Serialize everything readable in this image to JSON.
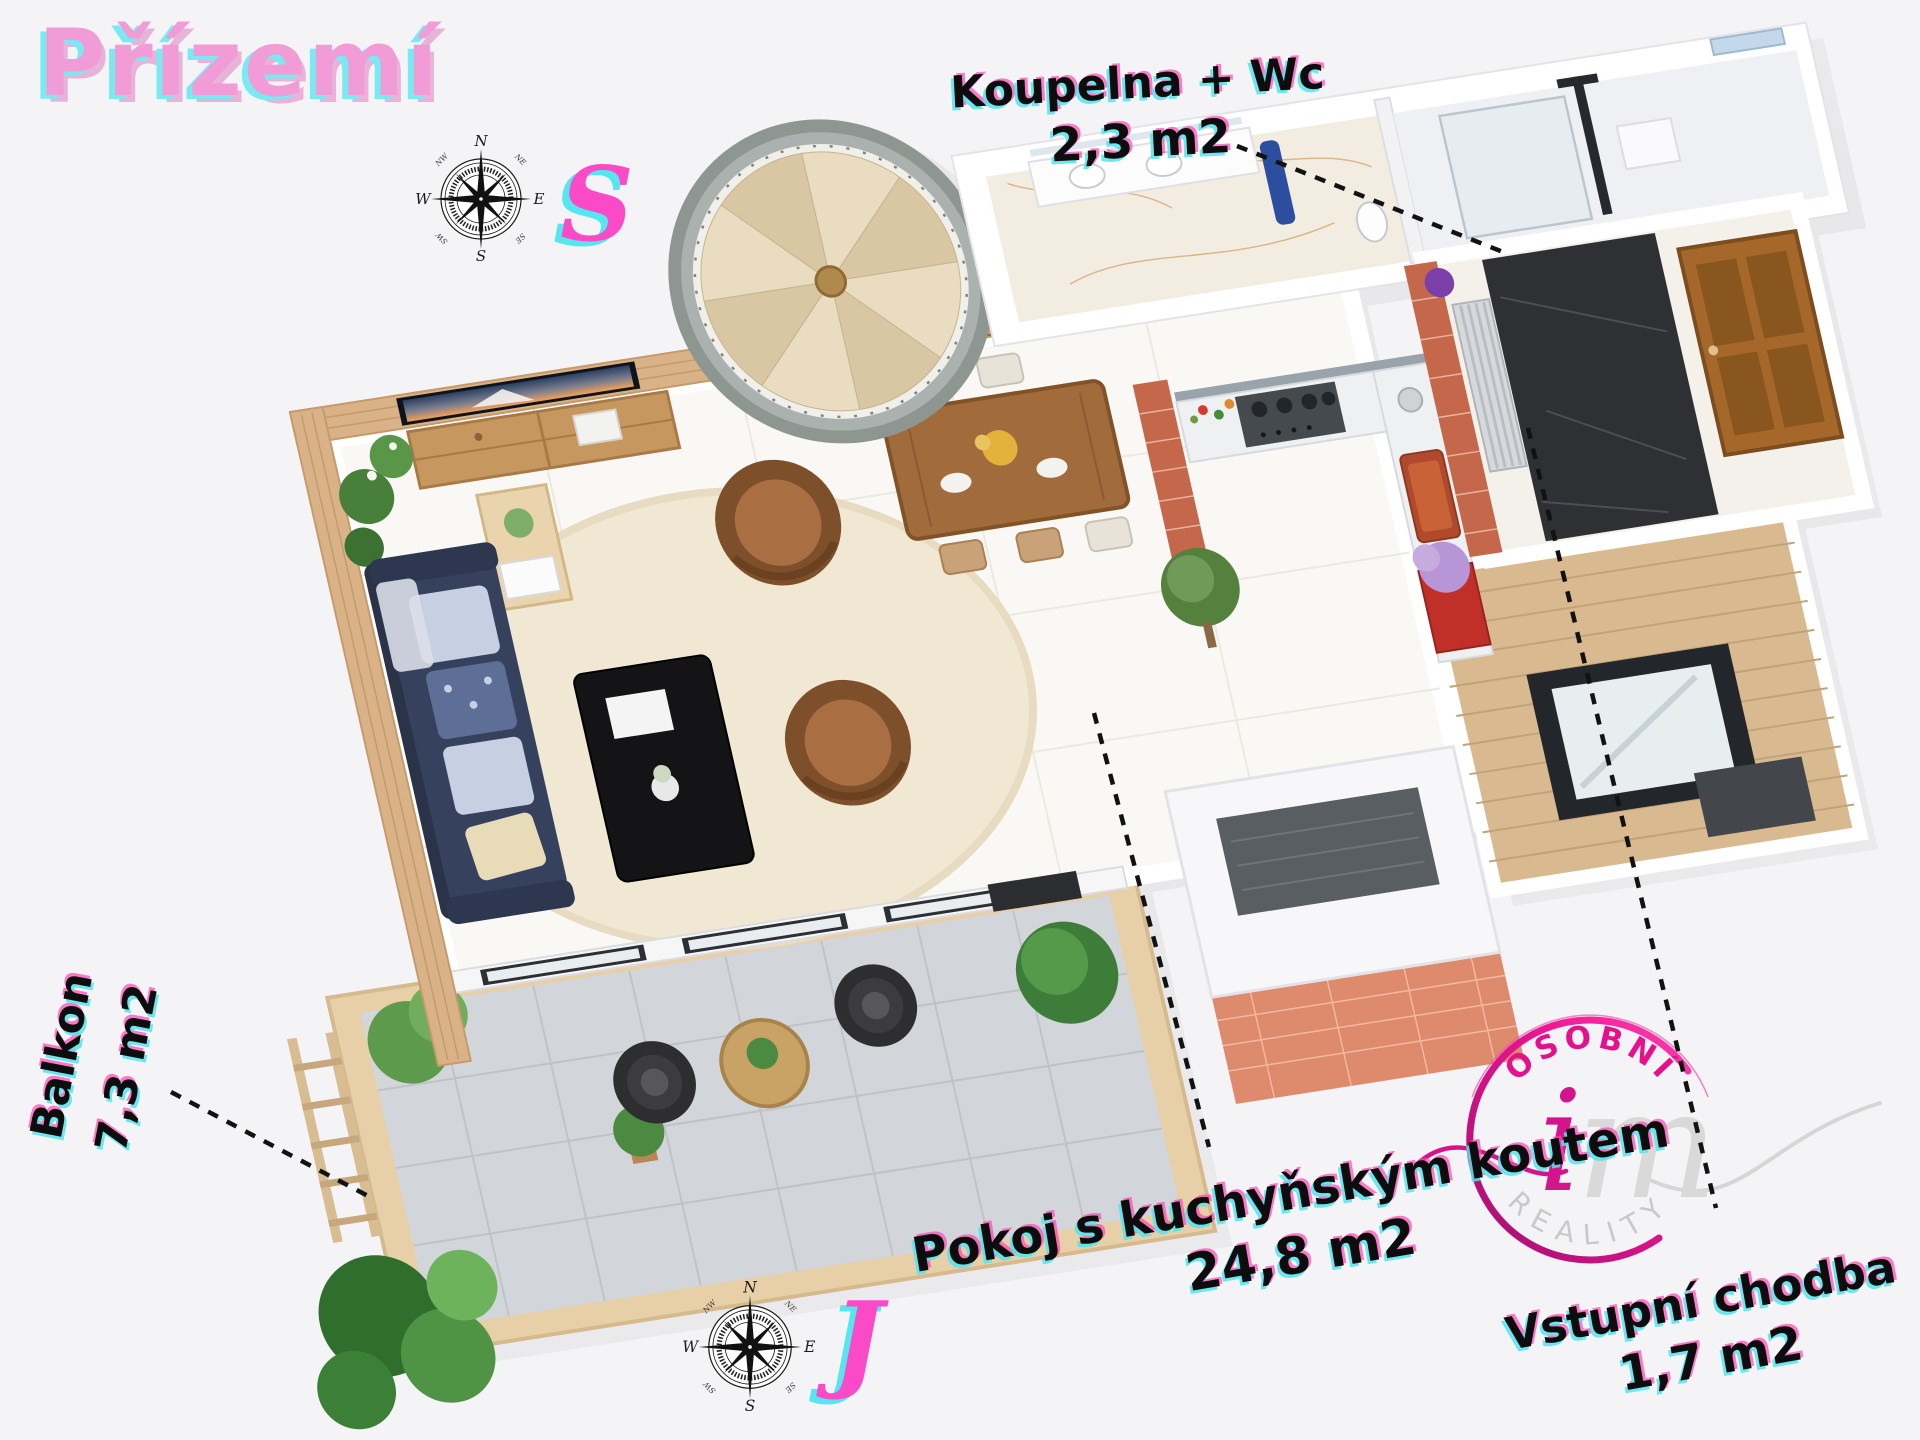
{
  "title": {
    "text": "Přízemí"
  },
  "direction_markers": {
    "top": "S",
    "bottom": "J"
  },
  "compass": {
    "n": "N",
    "e": "E",
    "s": "S",
    "w": "W",
    "nw": "NW",
    "ne": "NE",
    "sw": "SW",
    "se": "SE"
  },
  "room_labels": {
    "bathroom": {
      "name": "Koupelna + Wc",
      "area": "2,3 m2"
    },
    "balcony": {
      "name": "Balkon",
      "area": "7,3 m2"
    },
    "living_kitchen": {
      "name": "Pokoj s kuchyňským koutem",
      "area": "24,8 m2"
    },
    "entrance_hall": {
      "name": "Vstupní chodba",
      "area": "1,7 m2"
    }
  },
  "logo": {
    "arc_top": "OSOBNÍ",
    "monogram_i": "i",
    "monogram_m": "m",
    "arc_bottom": "REALITY"
  },
  "colors": {
    "background": "#f4f4f6",
    "title_pink": "#f19cd6",
    "marker_pink": "#fb4ac7",
    "shadow_cyan": "#6ce7f0",
    "fringe_magenta": "#ff44b3",
    "label_ink": "#0e0d0e",
    "logo_pink": "#e01187",
    "logo_gray": "#c9c9c9",
    "wood": "#d9b287",
    "brick": "#c4674a"
  }
}
